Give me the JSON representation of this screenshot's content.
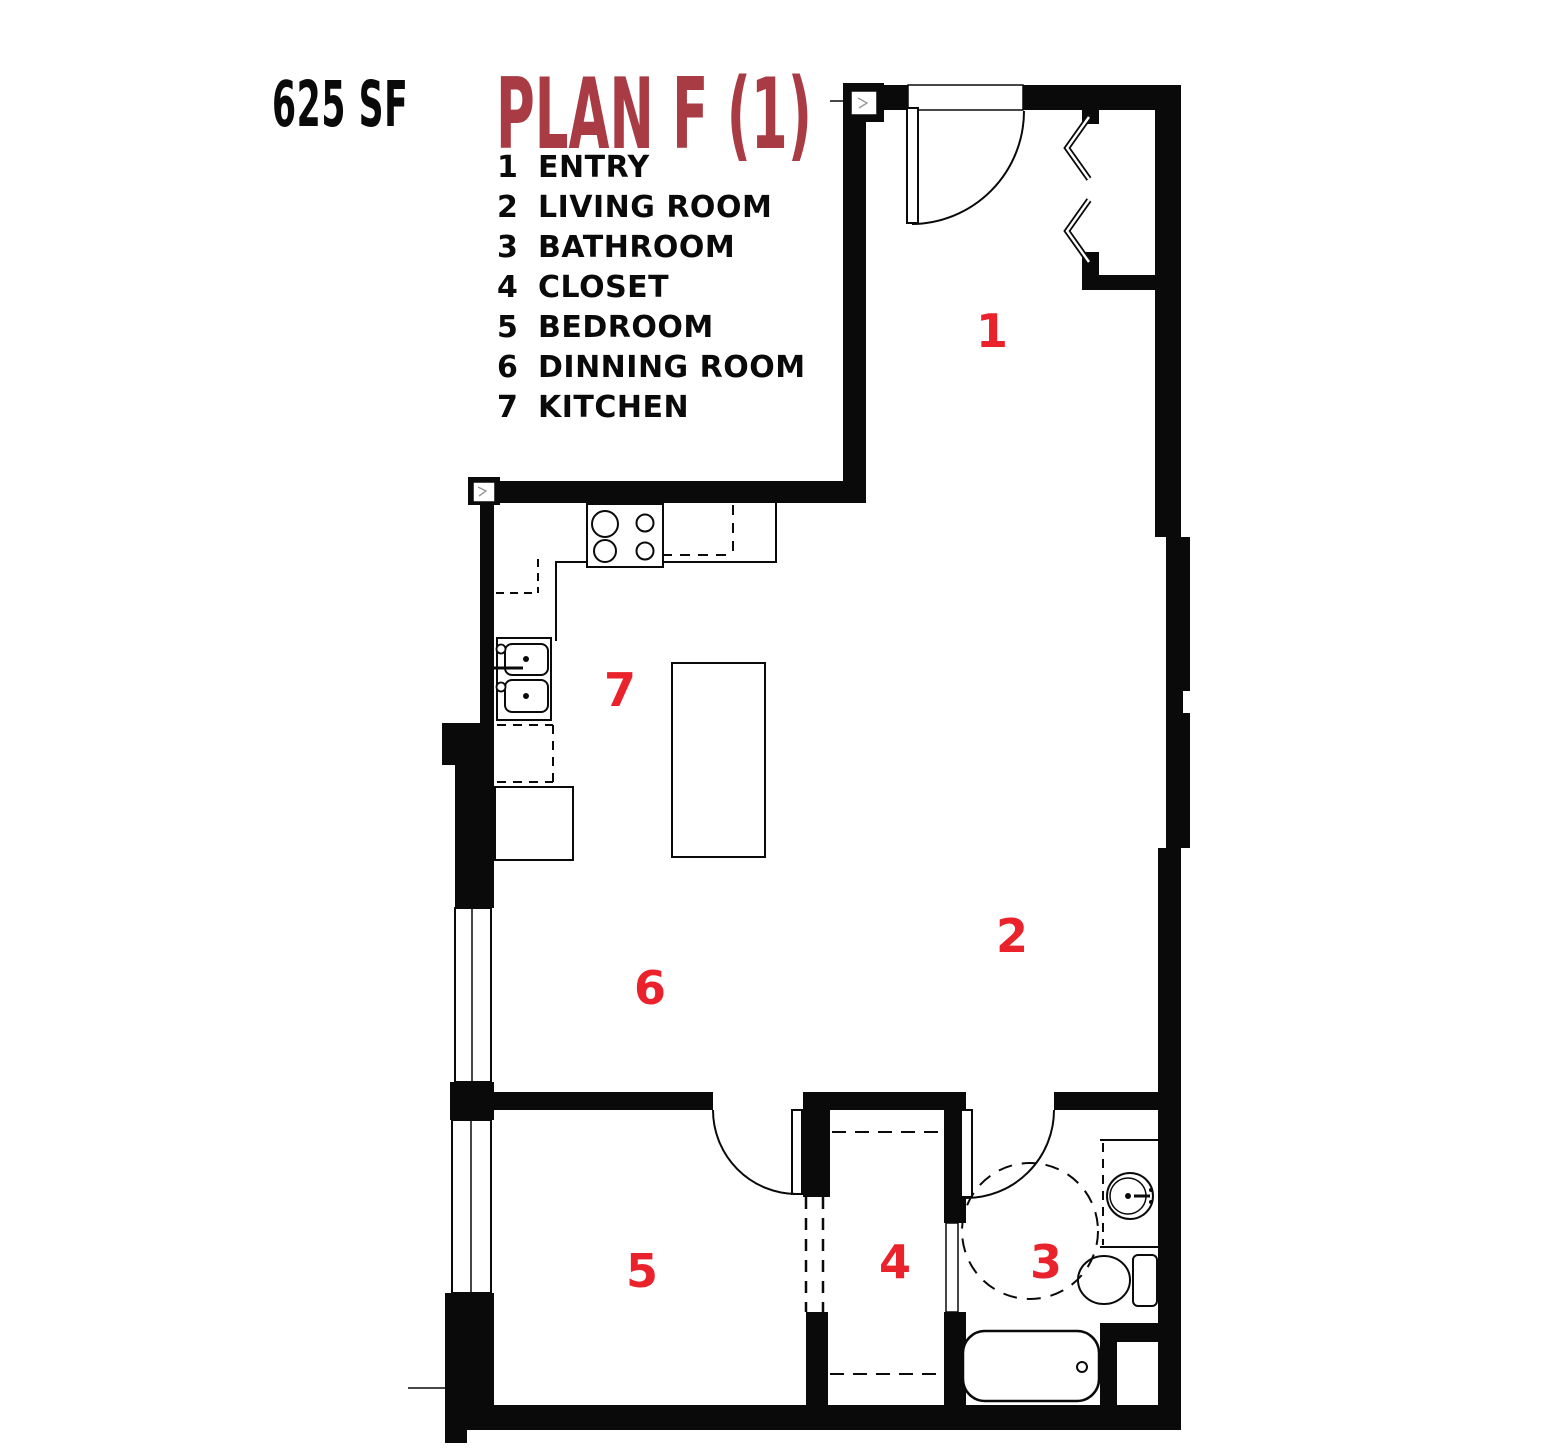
{
  "header": {
    "area_label": "625 SF",
    "title": "PLAN F (1)"
  },
  "legend": {
    "items": [
      {
        "num": "1",
        "label": "ENTRY"
      },
      {
        "num": "2",
        "label": "LIVING ROOM"
      },
      {
        "num": "3",
        "label": "BATHROOM"
      },
      {
        "num": "4",
        "label": "CLOSET"
      },
      {
        "num": "5",
        "label": "BEDROOM"
      },
      {
        "num": "6",
        "label": "DINNING ROOM"
      },
      {
        "num": "7",
        "label": "KITCHEN"
      }
    ]
  },
  "plan": {
    "room_labels": [
      {
        "num": "1",
        "room": "entry"
      },
      {
        "num": "2",
        "room": "living-room"
      },
      {
        "num": "3",
        "room": "bathroom"
      },
      {
        "num": "4",
        "room": "closet"
      },
      {
        "num": "5",
        "room": "bedroom"
      },
      {
        "num": "6",
        "room": "dinning-room"
      },
      {
        "num": "7",
        "room": "kitchen"
      }
    ]
  },
  "colors": {
    "walls": "#0a0a0a",
    "room_numbers": "#E9222B",
    "title": "#A93B45",
    "area_label": "#0a0a0a",
    "background": "#ffffff"
  }
}
